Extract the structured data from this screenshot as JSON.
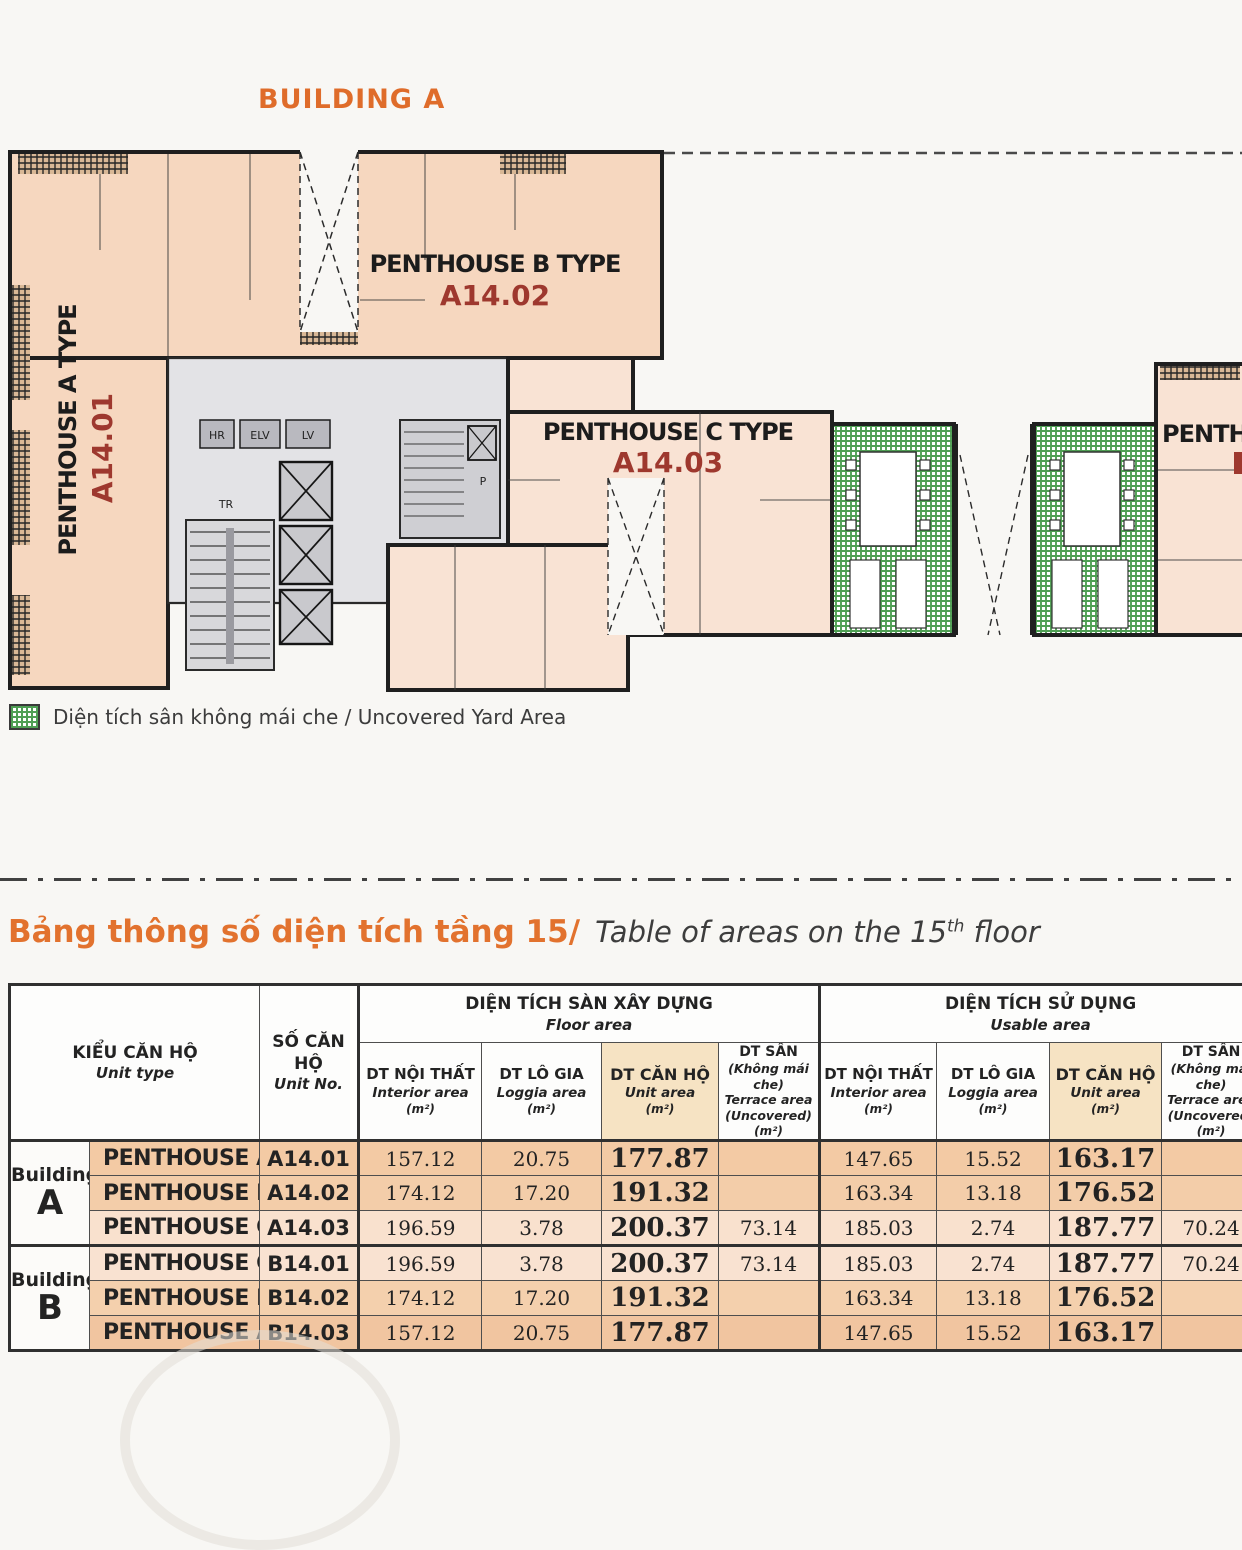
{
  "page": {
    "building_title": "BUILDING A"
  },
  "plan": {
    "units": [
      {
        "name": "PENTHOUSE A TYPE",
        "code": "A14.01"
      },
      {
        "name": "PENTHOUSE B TYPE",
        "code": "A14.02"
      },
      {
        "name": "PENTHOUSE C TYPE",
        "code": "A14.03"
      },
      {
        "name": "PENTHOUSE",
        "code": ""
      }
    ],
    "core_labels": {
      "hr": "HR",
      "elv": "ELV",
      "lv": "LV",
      "tr": "TR",
      "p": "P"
    },
    "colors": {
      "unit_fill": "#f6d7bf",
      "unit_fill_light": "#f9e3d4",
      "code_red": "#9e382e",
      "yard_green": "#4f9f54",
      "accent_orange": "#e2722e"
    }
  },
  "legend": {
    "label": "Diện tích sân không mái che / Uncovered Yard Area"
  },
  "section_title": {
    "vi": "Bảng thông số diện tích tầng 15/",
    "en_prefix": "Table of areas on the 15",
    "en_sup": "th",
    "en_suffix": " floor"
  },
  "table": {
    "headers": {
      "unit_type_vi": "KIỂU CĂN HỘ",
      "unit_type_en": "Unit type",
      "unit_no_vi": "SỐ CĂN HỘ",
      "unit_no_en": "Unit No.",
      "floor_group_vi": "DIỆN TÍCH SÀN XÂY DỰNG",
      "floor_group_en": "Floor area",
      "usable_group_vi": "DIỆN TÍCH SỬ DỤNG",
      "usable_group_en": "Usable area",
      "interior_vi": "DT NỘI THẤT",
      "interior_en": "Interior area",
      "loggia_vi": "DT LÔ GIA",
      "loggia_en": "Loggia area",
      "unitarea_vi": "DT CĂN HỘ",
      "unitarea_en": "Unit area",
      "terrace_vi": "DT SÂN",
      "terrace_en1": "(Không mái che)",
      "terrace_en2": "Terrace area",
      "terrace_en3": "(Uncovered)",
      "m2": "(m²)"
    },
    "groups": [
      {
        "label": "Building",
        "letter": "A",
        "rows": [
          {
            "type": "PENTHOUSE A",
            "no": "A14.01",
            "fi": "157.12",
            "fl": "20.75",
            "fu": "177.87",
            "ft": "",
            "ui": "147.65",
            "ul": "15.52",
            "uu": "163.17",
            "ut": ""
          },
          {
            "type": "PENTHOUSE B",
            "no": "A14.02",
            "fi": "174.12",
            "fl": "17.20",
            "fu": "191.32",
            "ft": "",
            "ui": "163.34",
            "ul": "13.18",
            "uu": "176.52",
            "ut": ""
          },
          {
            "type": "PENTHOUSE C",
            "no": "A14.03",
            "fi": "196.59",
            "fl": "3.78",
            "fu": "200.37",
            "ft": "73.14",
            "ui": "185.03",
            "ul": "2.74",
            "uu": "187.77",
            "ut": "70.24"
          }
        ]
      },
      {
        "label": "Building",
        "letter": "B",
        "rows": [
          {
            "type": "PENTHOUSE C",
            "no": "B14.01",
            "fi": "196.59",
            "fl": "3.78",
            "fu": "200.37",
            "ft": "73.14",
            "ui": "185.03",
            "ul": "2.74",
            "uu": "187.77",
            "ut": "70.24"
          },
          {
            "type": "PENTHOUSE B",
            "no": "B14.02",
            "fi": "174.12",
            "fl": "17.20",
            "fu": "191.32",
            "ft": "",
            "ui": "163.34",
            "ul": "13.18",
            "uu": "176.52",
            "ut": ""
          },
          {
            "type": "PENTHOUSE A",
            "no": "B14.03",
            "fi": "157.12",
            "fl": "20.75",
            "fu": "177.87",
            "ft": "",
            "ui": "147.65",
            "ul": "15.52",
            "uu": "163.17",
            "ut": ""
          }
        ]
      }
    ]
  }
}
